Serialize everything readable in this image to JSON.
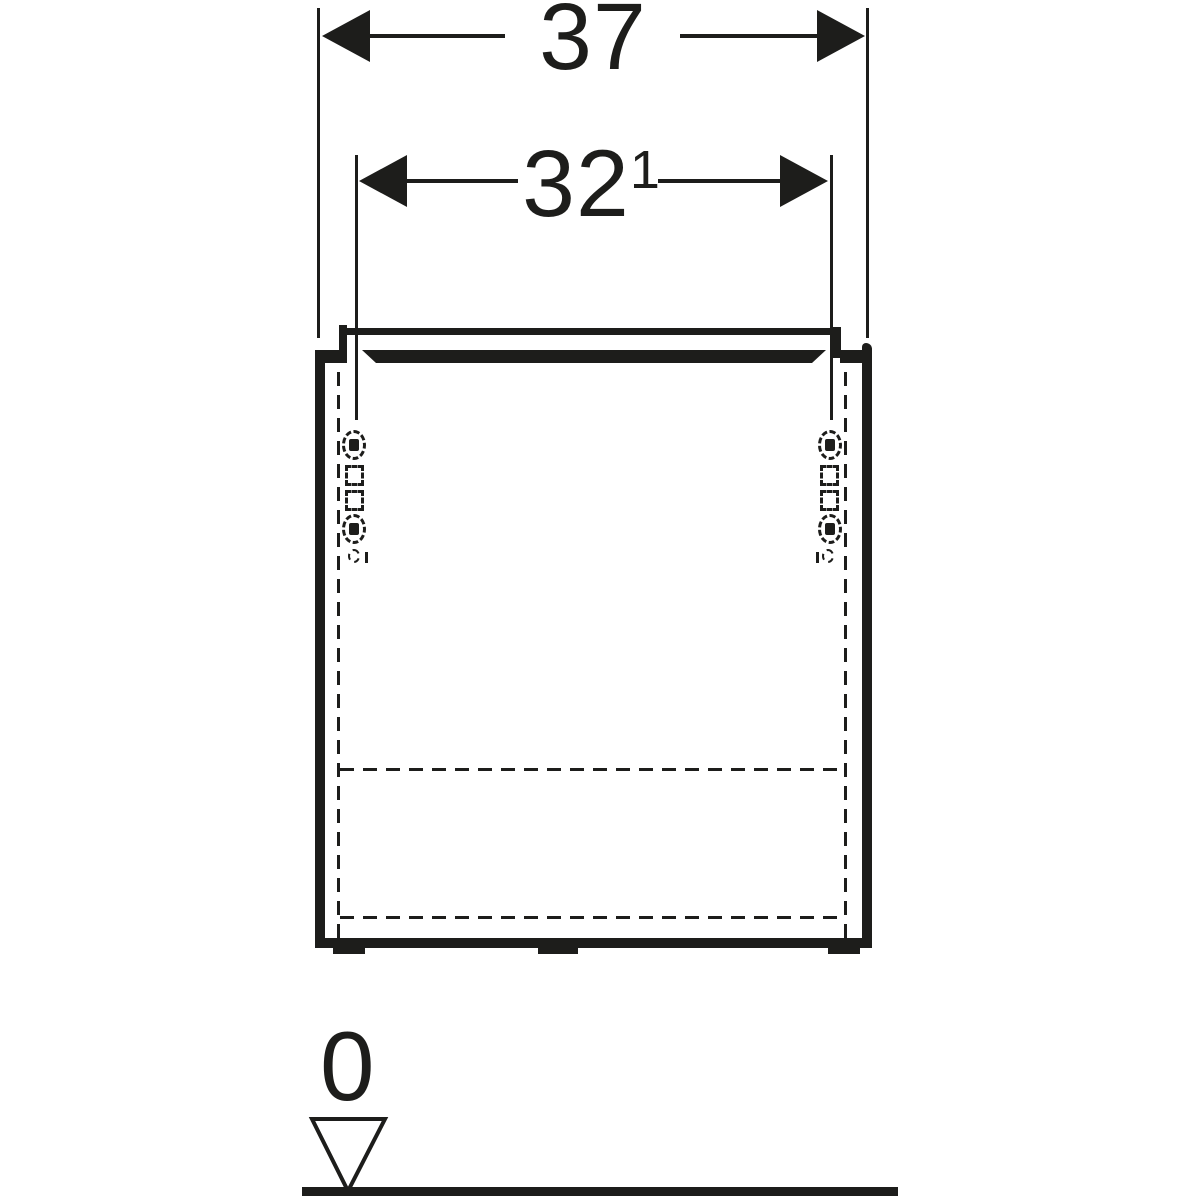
{
  "meta": {
    "description": "Technical front-view drawing of a wall-hung cabinet with washbasin slab, hinge fixing points, dimension lines and floor datum"
  },
  "colors": {
    "line": "#1d1d1b",
    "background": "#ffffff"
  },
  "dimensions": {
    "overall_width": "37",
    "fixing_distance": "32",
    "fixing_distance_superscript": "1",
    "datum_level": "0"
  },
  "icons": {
    "datum_triangle": "datum-level-triangle-icon",
    "arrowheads": "dimension-arrowhead-icon"
  }
}
